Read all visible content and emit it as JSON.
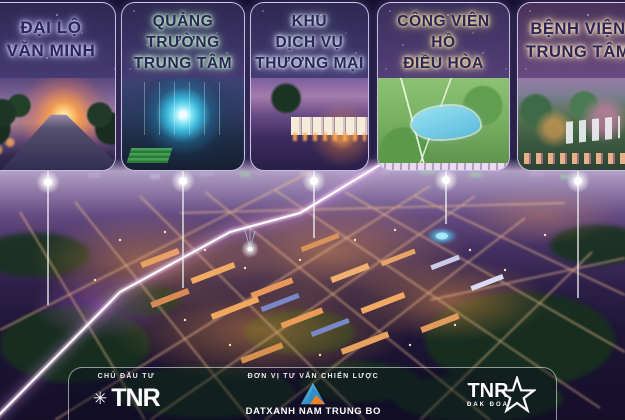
{
  "project": {
    "callouts": [
      {
        "id": "dai-lo-van-minh",
        "lines": [
          "ĐẠI LỘ",
          "VĂN MINH"
        ]
      },
      {
        "id": "quang-truong-trung-tam",
        "lines": [
          "QUẢNG",
          "TRƯỜNG",
          "TRUNG TÂM"
        ]
      },
      {
        "id": "khu-dich-vu-thuong-mai",
        "lines": [
          "KHU",
          "DỊCH VỤ",
          "THƯƠNG MẠI"
        ]
      },
      {
        "id": "cong-vien-ho-dieu-hoa",
        "lines": [
          "CÔNG VIÊN",
          "HỒ",
          "ĐIỀU HÒA"
        ]
      },
      {
        "id": "benh-vien-trung-tam",
        "lines": [
          "BỆNH VIỆN",
          "TRUNG TÂM"
        ]
      }
    ]
  },
  "footer": {
    "developer_label": "CHỦ ĐẦU TƯ",
    "developer_logo": "TNR",
    "consultant_label": "ĐƠN VỊ TƯ VẤN CHIẾN LƯỢC",
    "consultant_name": "DATXANH NAM TRUNG BO",
    "project_logo": "TNR",
    "project_logo_sub": "ĐAK ĐOA"
  },
  "icons": [
    "tnr-asterisk-icon",
    "datxanh-triangle-icon",
    "tnr-star-icon"
  ],
  "colors": {
    "card_text": "#2b2558",
    "card_glow_1": "#d6d2ff",
    "card_glow_2": "#d4ffd8",
    "card_glow_3": "#e6f1ff",
    "card_glow_4": "#ffedb2",
    "card_glow_5": "#ffe9c6",
    "avenue_beam": "#ffffff",
    "street_glow": "#ffc890",
    "city_glow": "#ffa850"
  }
}
